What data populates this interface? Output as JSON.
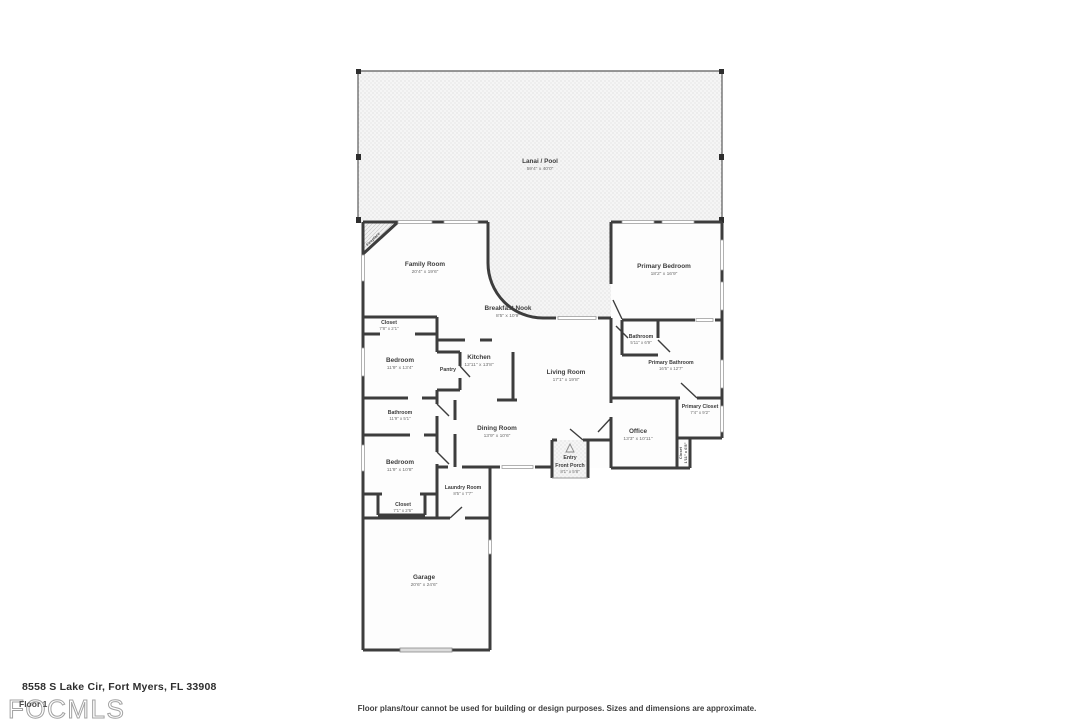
{
  "page": {
    "address": "8558 S Lake Cir, Fort Myers, FL 33908",
    "floor_label": "Floor 1",
    "watermark": "FOCMLS",
    "disclaimer": "Floor plans/tour cannot be used for building or design purposes. Sizes and dimensions are approximate."
  },
  "colors": {
    "wall": "#3d3d3d",
    "hatch_bg": "#f5f5f5",
    "hatch_dot": "#d9d9d9",
    "watermark_gray": "#a3a3a3"
  },
  "rooms": {
    "lanai": {
      "name": "Lanai / Pool",
      "dims": "59'4\" x 40'0\""
    },
    "family": {
      "name": "Family Room",
      "dims": "20'4\" x 19'6\""
    },
    "breakfast": {
      "name": "Breakfast Nook",
      "dims": "8'5\" x 10'9\""
    },
    "primary_bedroom": {
      "name": "Primary Bedroom",
      "dims": "18'2\" x 16'9\""
    },
    "closet_top": {
      "name": "Closet",
      "dims": "7'8\" x 2'1\""
    },
    "bedroom_upper": {
      "name": "Bedroom",
      "dims": "11'9\" x 13'4\""
    },
    "pantry": {
      "name": "Pantry"
    },
    "kitchen": {
      "name": "Kitchen",
      "dims": "12'11\" x 13'8\""
    },
    "bathroom_left": {
      "name": "Bathroom",
      "dims": "11'9\" x 5'1\""
    },
    "bedroom_lower": {
      "name": "Bedroom",
      "dims": "11'9\" x 10'8\""
    },
    "closet_bottom": {
      "name": "Closet",
      "dims": "7'1\" x 2'6\""
    },
    "laundry": {
      "name": "Laundry Room",
      "dims": "8'5\" x 7'7\""
    },
    "dining": {
      "name": "Dining Room",
      "dims": "13'9\" x 10'6\""
    },
    "living": {
      "name": "Living Room",
      "dims": "17'1\" x 19'8\""
    },
    "entry": {
      "name": "Entry"
    },
    "front_porch": {
      "name": "Front Porch",
      "dims": "8'1\" x 5'8\""
    },
    "bathroom_right": {
      "name": "Bathroom",
      "dims": "5'11\" x 6'9\""
    },
    "primary_bathroom": {
      "name": "Primary Bathroom",
      "dims": "16'5\" x 12'7\""
    },
    "primary_closet": {
      "name": "Primary Closet",
      "dims": "7'4\" x 9'2\""
    },
    "closet_hall": {
      "name": "Closet",
      "dims": "1'11\" x 6'8\""
    },
    "office": {
      "name": "Office",
      "dims": "13'3\" x 10'11\""
    },
    "garage": {
      "name": "Garage",
      "dims": "20'6\" x 24'6\""
    },
    "fireplace": {
      "name": "Fireplace"
    }
  }
}
